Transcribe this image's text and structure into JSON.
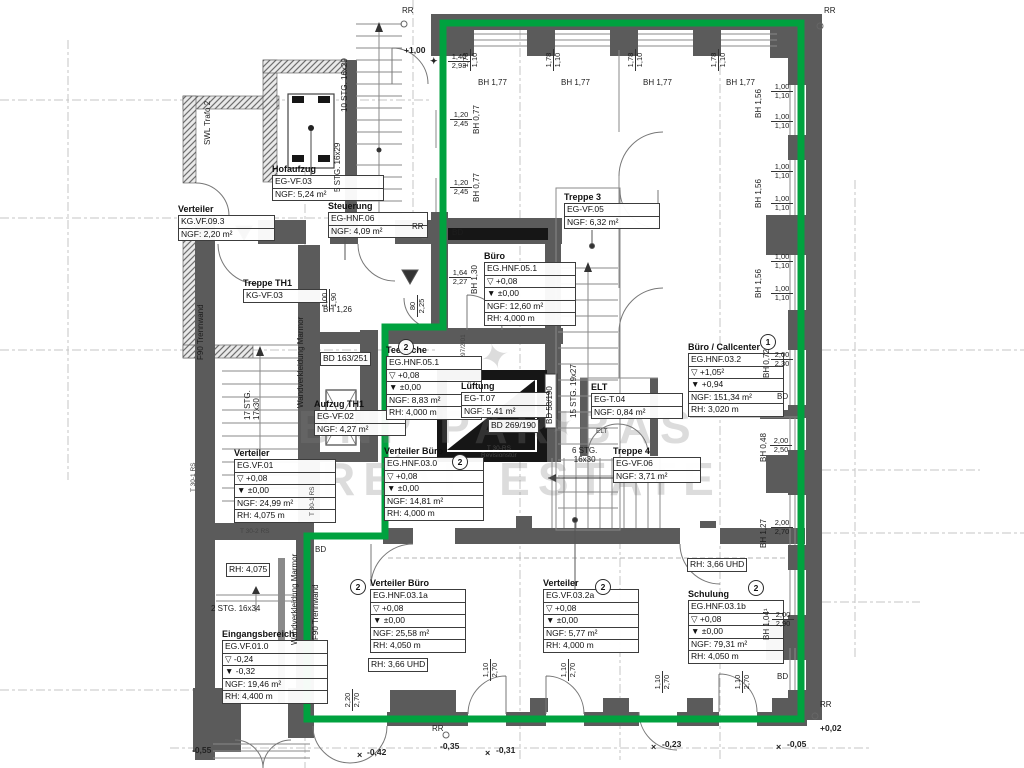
{
  "colors": {
    "outline_green": "#00A23F",
    "wall_gray": "#5b5b5b",
    "black_wall": "#161616"
  },
  "watermark": {
    "line1": "BNP PARIBAS",
    "line2": "REAL ESTATE",
    "star": "✦"
  },
  "rooms": {
    "hofaufzug": {
      "title": "Hofaufzug",
      "lines": [
        "EG-VF.03",
        "NGF: 5,24 m²"
      ]
    },
    "verteiler_kg": {
      "title": "Verteiler",
      "lines": [
        "KG.VF.09.3",
        "NGF: 2,20 m²"
      ]
    },
    "steuerung": {
      "title": "Steuerung",
      "lines": [
        "EG-HNF.06",
        "NGF: 4,09 m²"
      ]
    },
    "treppe_th1": {
      "title": "Treppe TH1",
      "lines": [
        "KG-VF.03"
      ]
    },
    "aufzug_th1": {
      "title": "Aufzug TH1",
      "lines": [
        "EG-VF.02",
        "NGF: 4,27 m²"
      ]
    },
    "buero": {
      "title": "Büro",
      "lines": [
        "EG.HNF.05.1",
        "▽ +0,08",
        "▼ ±0,00",
        "NGF: 12,60 m²",
        "RH:  4,000 m"
      ]
    },
    "treppe3": {
      "title": "Treppe 3",
      "lines": [
        "EG-VF.05",
        "NGF: 6,32 m²"
      ]
    },
    "teekueche": {
      "title": "Teeküche",
      "badge": "2",
      "lines": [
        "EG.HNF.05.1",
        "▽ +0,08",
        "▼ ±0,00",
        "NGF: 8,83 m²",
        "RH: 4,000 m"
      ]
    },
    "lueftung": {
      "title": "Lüftung",
      "lines": [
        "EG-T.07",
        "NGF: 5,41 m²"
      ]
    },
    "elt": {
      "title": "ELT",
      "lines": [
        "EG-T.04",
        "NGF: 0,84 m²"
      ]
    },
    "callcenter": {
      "title": "Büro / Callcenter",
      "badge": "1",
      "lines": [
        "EG.HNF.03.2",
        "▽ +1,05²",
        "▼ +0,94",
        "NGF: 151,34 m²",
        "RH:  3,020 m"
      ]
    },
    "verteiler_eg": {
      "title": "Verteiler",
      "lines": [
        "EG.VF.01",
        "▽ +0,08",
        "▼ ±0,00",
        "NGF: 24,99 m²",
        "RH:  4,075 m"
      ]
    },
    "verteiler_buero": {
      "title": "Verteiler Büro",
      "badge": "2",
      "lines": [
        "EG.HNF.03.0",
        "▽ +0,08",
        "▼ ±0,00",
        "NGF: 14,81 m²",
        "RH:  4,000 m"
      ]
    },
    "treppe4": {
      "title": "Treppe 4",
      "lines": [
        "EG-VF.06",
        "NGF: 3,71 m²"
      ]
    },
    "eingang": {
      "title": "Eingangsbereich",
      "lines": [
        "EG.VF.01.0",
        "▽ -0,24",
        "▼ -0,32",
        "NGF:  19,46 m²",
        "RH:  4,400 m"
      ]
    },
    "verteiler_b1a": {
      "title": "Verteiler Büro",
      "badge": "2",
      "lines": [
        "EG.HNF.03.1a",
        "▽ +0,08",
        "▼ ±0,00",
        "NGF: 25,58 m²",
        "RH:  4,050 m"
      ]
    },
    "verteiler_32a": {
      "title": "Verteiler",
      "badge": "2",
      "lines": [
        "EG.VF.03.2a",
        "▽ +0,08",
        "▼ ±0,00",
        "NGF: 5,77 m²",
        "RH: 4,000 m"
      ]
    },
    "schulung": {
      "title": "Schulung",
      "badge": "2",
      "lines": [
        "EG.HNF.03.1b",
        "▽ +0,08",
        "▼ ±0,00",
        "NGF: 79,31 m²",
        "RH:  4,050 m"
      ]
    }
  },
  "boxes": {
    "rh4075": "RH: 4,075",
    "rh366": "RH: 3,66 UHD",
    "bd163": "BD 163/251",
    "bd269": "BD 269/190"
  },
  "stairs": {
    "stg10": "10 STG. 16x29",
    "stg5": "5 STG. 16x29",
    "stg17": "17 STG.\n17x30",
    "stg15": "15 STG. 19x27",
    "stg6": "6 STG.\n16x30",
    "stg2": "2 STG. 16x34"
  },
  "labels": {
    "swl": "SWL Trafo 2",
    "f90": "F90 Trennwand",
    "marmor": "Wandverkleidung Marmor",
    "t30_1": "T 30-1 RS",
    "t30_2": "T 30-2 RS",
    "t30rs_rev": "T 30-RS\nRevisionstür",
    "n97": "97/2/01",
    "bd": "BD",
    "bd58": "BD 58/190",
    "elt_small": "ELT",
    "rr": "RR",
    "benchmark": "×",
    "star": "✦"
  },
  "dims": {
    "bh177": "BH 1,77",
    "w178": "1,78\n1,10",
    "w100": "1,00\n1,10",
    "bh156": "BH 1,56",
    "d140": "1,40\n2,93",
    "d120": "1,20\n2,45",
    "bh077": "BH 0,77",
    "d164": "1,64\n2,27",
    "bh130": "BH 1,30",
    "d80": "80\n2,25",
    "d100_190": "1,00\n1,90",
    "bh126": "BH 1,26",
    "bh072": "BH 0,72",
    "d200_230": "2,00\n2,30",
    "bh048": "BH 0,48",
    "d200_250": "2,00\n2,50",
    "bh127": "BH 1,27",
    "d200_270": "2,00\n2,70",
    "bh104": "BH 1,04¹",
    "d200_290": "2,00\n2,90",
    "d110_270": "1,10\n2,70",
    "d220_270": "2,20\n2,70"
  },
  "levels": {
    "p100": "+1,00",
    "m055": "-0,55",
    "m042": "-0,42",
    "m035": "-0,35",
    "m031": "-0,31",
    "m023": "-0,23",
    "m005": "-0,05",
    "p002": "+0,02"
  }
}
